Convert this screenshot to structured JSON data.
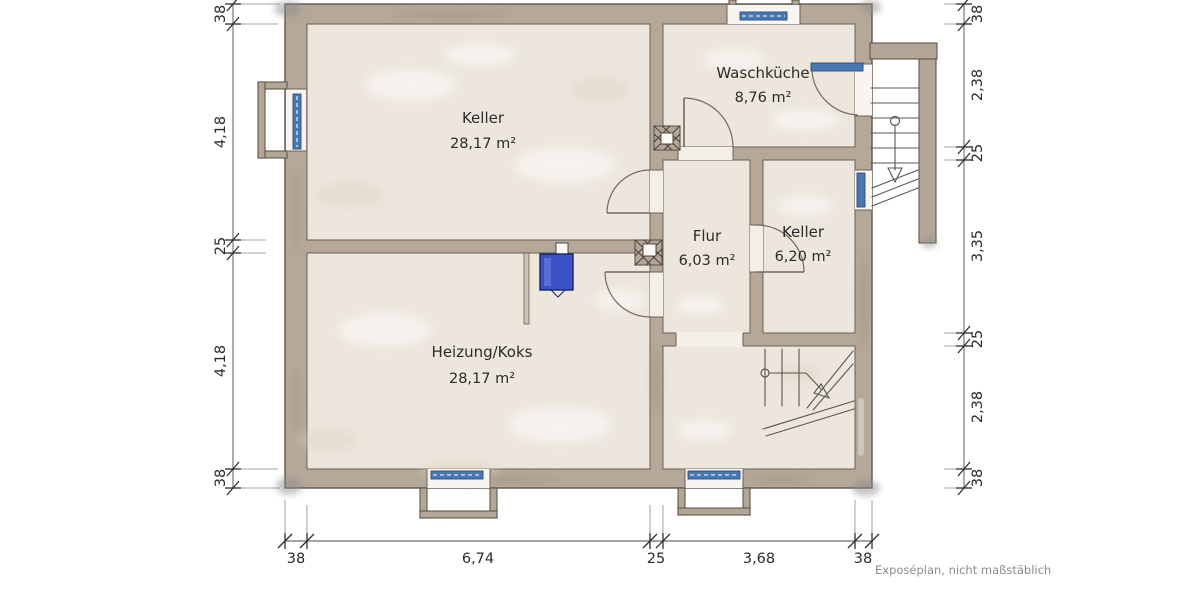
{
  "plan": {
    "type": "floor-plan-basement",
    "rooms": [
      {
        "id": "keller-gross",
        "name": "Keller",
        "area": "28,17 m²"
      },
      {
        "id": "waschkueche",
        "name": "Waschküche",
        "area": "8,76 m²"
      },
      {
        "id": "flur",
        "name": "Flur",
        "area": "6,03 m²"
      },
      {
        "id": "keller-klein",
        "name": "Keller",
        "area": "6,20 m²"
      },
      {
        "id": "heizung-koks",
        "name": "Heizung/Koks",
        "area": "28,17 m²"
      }
    ],
    "dimensions": {
      "left": [
        "38",
        "4,18",
        "25",
        "4,18",
        "38"
      ],
      "right": [
        "38",
        "2,38",
        "25",
        "3,35",
        "25",
        "2,38",
        "38"
      ],
      "bottom": [
        "38",
        "6,74",
        "25",
        "3,68",
        "38"
      ]
    },
    "caption": "Exposéplan, nicht maßstäblich",
    "colors": {
      "wall": "#b5a899",
      "floor": "#ece6dd",
      "window": "#4a79b2",
      "boiler": "#3b51c5",
      "line": "#5e564b",
      "dimension_text": "#2b2b2b",
      "caption_text": "#8b8b8b"
    }
  }
}
